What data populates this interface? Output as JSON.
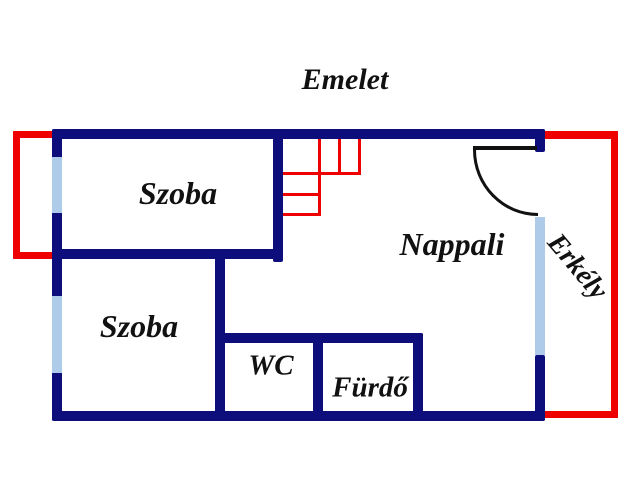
{
  "title": "Emelet",
  "rooms": {
    "szoba_top": {
      "label": "Szoba"
    },
    "szoba_bottom": {
      "label": "Szoba"
    },
    "nappali": {
      "label": "Nappali"
    },
    "wc": {
      "label": "WC"
    },
    "furdo": {
      "label": "Fürdő"
    },
    "erkely": {
      "label": "Erkély"
    }
  },
  "icons": {
    "door_swing": "door-swing-arc",
    "stairs": "staircase",
    "windows": "window-segment",
    "balcony_outline": "balcony-outline"
  },
  "colors": {
    "wall": "#0d0d7c",
    "window": "#aecbea",
    "balcony": "#ee0000",
    "door": "#111111",
    "text": "#111111",
    "background": "#ffffff"
  }
}
